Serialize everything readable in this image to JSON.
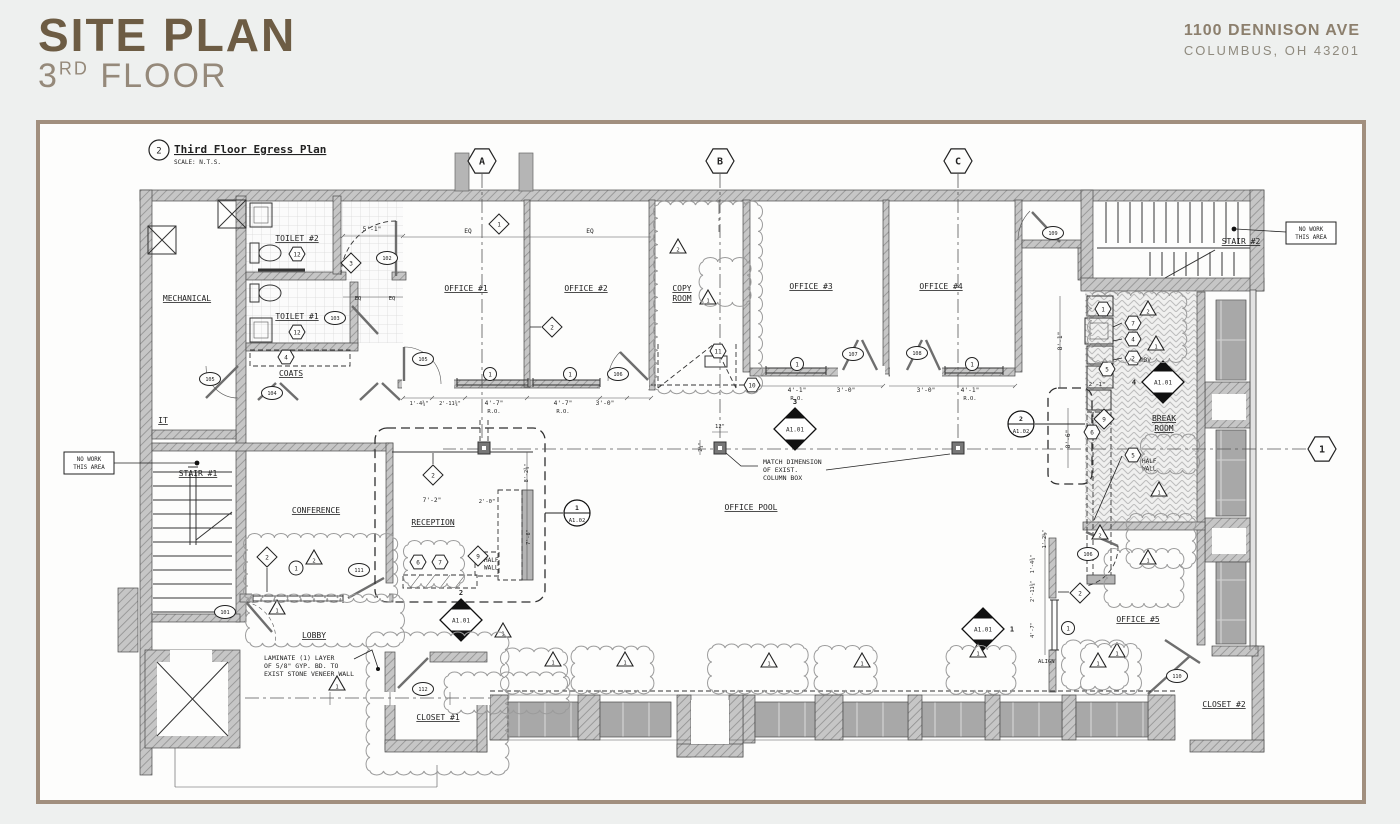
{
  "header": {
    "title": "SITE PLAN",
    "subtitle": {
      "num": "3",
      "sup": "RD",
      "rest": " FLOOR"
    },
    "address1": "1100 DENNISON AVE",
    "address2": "COLUMBUS, OH 43201",
    "title_color": "#6d5c44",
    "frame_color": "#a18f7e"
  },
  "plan": {
    "title_block": {
      "number": "2",
      "title": "Third Floor Egress Plan",
      "scale": "SCALE: N.T.S."
    },
    "rooms": [
      {
        "t": "MECHANICAL",
        "x": 187,
        "y": 301
      },
      {
        "t": "IT",
        "x": 163,
        "y": 423
      },
      {
        "t": "TOILET #2",
        "x": 297,
        "y": 241
      },
      {
        "t": "TOILET #1",
        "x": 297,
        "y": 319
      },
      {
        "t": "COATS",
        "x": 291,
        "y": 376
      },
      {
        "t": "STAIR #1",
        "x": 198,
        "y": 476
      },
      {
        "t": "STAIR #2",
        "x": 1241,
        "y": 244
      },
      {
        "t": "CONFERENCE",
        "x": 316,
        "y": 513
      },
      {
        "t": "RECEPTION",
        "x": 433,
        "y": 525
      },
      {
        "t": "LOBBY",
        "x": 314,
        "y": 638
      },
      {
        "t": "CLOSET #1",
        "x": 438,
        "y": 720
      },
      {
        "t": "CLOSET #2",
        "x": 1224,
        "y": 707
      },
      {
        "t": "OFFICE #1",
        "x": 466,
        "y": 291
      },
      {
        "t": "OFFICE #2",
        "x": 586,
        "y": 291
      },
      {
        "t": "OFFICE #3",
        "x": 811,
        "y": 289
      },
      {
        "t": "OFFICE #4",
        "x": 941,
        "y": 289
      },
      {
        "t": "OFFICE #5",
        "x": 1138,
        "y": 622
      },
      {
        "t": "OFFICE POOL",
        "x": 751,
        "y": 510
      },
      {
        "t": "COPY",
        "x": 682,
        "y": 291
      },
      {
        "t": "ROOM",
        "x": 682,
        "y": 301
      },
      {
        "t": "BREAK",
        "x": 1164,
        "y": 421
      },
      {
        "t": "ROOM",
        "x": 1164,
        "y": 431
      }
    ],
    "notes": [
      {
        "lines": [
          "MATCH DIMENSION",
          "OF EXIST.",
          "COLUMN BOX"
        ],
        "x": 763,
        "y": 464,
        "s": 6.5
      },
      {
        "lines": [
          "LAMINATE (1) LAYER",
          "OF 5/8\" GYP. BD. TO",
          "EXIST STONE VENEER WALL"
        ],
        "x": 264,
        "y": 660,
        "s": 6.5
      },
      {
        "lines": [
          "HALF",
          "WALL"
        ],
        "x": 484,
        "y": 562,
        "s": 6
      },
      {
        "lines": [
          "HALF",
          "WALL"
        ],
        "x": 1142,
        "y": 463,
        "s": 6
      },
      {
        "lines": [
          "ABV"
        ],
        "x": 1140,
        "y": 362,
        "s": 6
      },
      {
        "lines": [
          "ALIGN"
        ],
        "x": 1038,
        "y": 663,
        "s": 5.5
      }
    ],
    "no_work_boxes": [
      {
        "lines": [
          "NO WORK",
          "THIS AREA"
        ],
        "x": 64,
        "y": 452,
        "w": 50,
        "h": 22,
        "leader": [
          114,
          463,
          195,
          463
        ],
        "dot": [
          197,
          463
        ]
      },
      {
        "lines": [
          "NO WORK",
          "THIS AREA"
        ],
        "x": 1286,
        "y": 222,
        "w": 50,
        "h": 22,
        "leader": [
          1286,
          232,
          1236,
          229
        ],
        "dot": [
          1234,
          229
        ]
      }
    ],
    "dims": [
      {
        "t": "5'-1\"",
        "x": 372,
        "y": 231
      },
      {
        "t": "EQ",
        "x": 358,
        "y": 300,
        "s": 5.5
      },
      {
        "t": "EQ",
        "x": 392,
        "y": 300,
        "s": 5.5
      },
      {
        "t": "EQ",
        "x": 468,
        "y": 233
      },
      {
        "t": "EQ",
        "x": 590,
        "y": 233
      },
      {
        "t": "1'-4¾\"",
        "x": 419,
        "y": 405,
        "s": 5.2
      },
      {
        "t": "2'-11¾\"",
        "x": 450,
        "y": 405,
        "s": 5.2
      },
      {
        "t": "4'-7\"",
        "x": 494,
        "y": 405
      },
      {
        "t": "R.O.",
        "x": 494,
        "y": 413,
        "s": 5.5
      },
      {
        "t": "4'-7\"",
        "x": 563,
        "y": 405
      },
      {
        "t": "R.O.",
        "x": 563,
        "y": 413,
        "s": 5.5
      },
      {
        "t": "3'-0\"",
        "x": 605,
        "y": 405
      },
      {
        "t": "4'-1\"",
        "x": 797,
        "y": 392
      },
      {
        "t": "R.O.",
        "x": 797,
        "y": 400,
        "s": 5.5
      },
      {
        "t": "3'-0\"",
        "x": 846,
        "y": 392
      },
      {
        "t": "3'-0\"",
        "x": 926,
        "y": 392
      },
      {
        "t": "4'-1\"",
        "x": 970,
        "y": 392
      },
      {
        "t": "R.O.",
        "x": 970,
        "y": 400,
        "s": 5.5
      },
      {
        "t": "12\"",
        "x": 720,
        "y": 428,
        "s": 5.5
      },
      {
        "t": "2¼\"",
        "x": 702,
        "y": 447,
        "r": -90,
        "s": 5.2
      },
      {
        "t": "8'-1\"",
        "x": 1062,
        "y": 341,
        "r": -90
      },
      {
        "t": "2'-1\"",
        "x": 1097,
        "y": 386,
        "s": 5.5
      },
      {
        "t": "8'-6\"",
        "x": 1070,
        "y": 439,
        "r": -90
      },
      {
        "t": "8'-2¾\"",
        "x": 528,
        "y": 473,
        "r": -90,
        "s": 5.2
      },
      {
        "t": "7'-6\"",
        "x": 530,
        "y": 537,
        "r": -90,
        "s": 5.2
      },
      {
        "t": "7'-2\"",
        "x": 432,
        "y": 502
      },
      {
        "t": "2'-0\"",
        "x": 487,
        "y": 503,
        "s": 5.5
      },
      {
        "t": "1'-2½\"",
        "x": 1046,
        "y": 539,
        "r": -90,
        "s": 5.2
      },
      {
        "t": "1'-4¾\"",
        "x": 1034,
        "y": 564,
        "r": -90,
        "s": 5.2
      },
      {
        "t": "2'-11¾\"",
        "x": 1034,
        "y": 591,
        "r": -90,
        "s": 5.2
      },
      {
        "t": "4'-7\"",
        "x": 1034,
        "y": 630,
        "r": -90,
        "s": 5.2
      }
    ],
    "grid_markers": [
      {
        "l": "A",
        "x": 482,
        "y": 161,
        "line": [
          482,
          174,
          482,
          446
        ]
      },
      {
        "l": "B",
        "x": 720,
        "y": 161,
        "line": [
          720,
          174,
          720,
          446
        ]
      },
      {
        "l": "C",
        "x": 958,
        "y": 161,
        "line": [
          958,
          174,
          958,
          446
        ]
      },
      {
        "l": "1",
        "x": 1322,
        "y": 449,
        "line": [
          1306,
          449,
          443,
          449
        ]
      }
    ],
    "section_markers": [
      {
        "x": 795,
        "y": 429,
        "sheet": "A1.01",
        "n": "3",
        "side": "top"
      },
      {
        "x": 461,
        "y": 620,
        "sheet": "A1.01",
        "n": "2",
        "side": "top"
      },
      {
        "x": 1163,
        "y": 382,
        "sheet": "A1.01",
        "n": "4",
        "side": "left"
      },
      {
        "x": 983,
        "y": 629,
        "sheet": "A1.01",
        "n": "1",
        "side": "right"
      }
    ],
    "detail_markers": [
      {
        "x": 577,
        "y": 513,
        "n": "1",
        "sheet": "A1.02",
        "leader": [
          563,
          513,
          545,
          513
        ]
      },
      {
        "x": 1021,
        "y": 424,
        "n": "2",
        "sheet": "A1.02",
        "leader": [
          1035,
          424,
          1085,
          424
        ]
      }
    ],
    "hex_keynotes": [
      {
        "n": "12",
        "x": 297,
        "y": 254
      },
      {
        "n": "12",
        "x": 297,
        "y": 332
      },
      {
        "n": "4",
        "x": 286,
        "y": 357
      },
      {
        "n": "11",
        "x": 718,
        "y": 351
      },
      {
        "n": "10",
        "x": 752,
        "y": 385
      },
      {
        "n": "1",
        "x": 1103,
        "y": 309
      },
      {
        "n": "7",
        "x": 1133,
        "y": 323
      },
      {
        "n": "4",
        "x": 1133,
        "y": 339
      },
      {
        "n": "2",
        "x": 1133,
        "y": 358
      },
      {
        "n": "5",
        "x": 1107,
        "y": 369
      },
      {
        "n": "6",
        "x": 1092,
        "y": 432
      },
      {
        "n": "5",
        "x": 1133,
        "y": 455
      },
      {
        "n": "6",
        "x": 418,
        "y": 562
      },
      {
        "n": "7",
        "x": 440,
        "y": 562
      }
    ],
    "diamond_keynotes": [
      {
        "n": "1",
        "x": 499,
        "y": 224
      },
      {
        "n": "2",
        "x": 552,
        "y": 327
      },
      {
        "n": "3",
        "x": 351,
        "y": 263
      },
      {
        "n": "2",
        "x": 433,
        "y": 475
      },
      {
        "n": "2",
        "x": 267,
        "y": 557
      },
      {
        "n": "9",
        "x": 478,
        "y": 556
      },
      {
        "n": "2",
        "x": 1080,
        "y": 593
      },
      {
        "n": "9",
        "x": 1104,
        "y": 419
      }
    ],
    "circle_keynotes": [
      {
        "n": "1",
        "x": 296,
        "y": 568
      }
    ],
    "window_tags": [
      {
        "n": "1",
        "x": 490,
        "y": 374
      },
      {
        "n": "1",
        "x": 570,
        "y": 374
      },
      {
        "n": "1",
        "x": 797,
        "y": 364
      },
      {
        "n": "1",
        "x": 972,
        "y": 364
      },
      {
        "n": "1",
        "x": 1068,
        "y": 628
      }
    ],
    "door_tags": [
      {
        "n": "101",
        "x": 225,
        "y": 612
      },
      {
        "n": "102",
        "x": 387,
        "y": 258
      },
      {
        "n": "103",
        "x": 335,
        "y": 318
      },
      {
        "n": "104",
        "x": 272,
        "y": 393
      },
      {
        "n": "105",
        "x": 210,
        "y": 379
      },
      {
        "n": "105",
        "x": 423,
        "y": 359
      },
      {
        "n": "106",
        "x": 618,
        "y": 374
      },
      {
        "n": "107",
        "x": 853,
        "y": 354
      },
      {
        "n": "108",
        "x": 917,
        "y": 353
      },
      {
        "n": "109",
        "x": 1053,
        "y": 233
      },
      {
        "n": "110",
        "x": 1177,
        "y": 676
      },
      {
        "n": "111",
        "x": 359,
        "y": 570
      },
      {
        "n": "112",
        "x": 423,
        "y": 689
      },
      {
        "n": "106",
        "x": 1088,
        "y": 554
      }
    ],
    "triangles": [
      {
        "n": "2",
        "x": 678,
        "y": 247
      },
      {
        "n": "1",
        "x": 708,
        "y": 298
      },
      {
        "n": "2",
        "x": 314,
        "y": 558
      },
      {
        "n": "1",
        "x": 277,
        "y": 608
      },
      {
        "n": "2",
        "x": 1100,
        "y": 533
      },
      {
        "n": "1",
        "x": 1148,
        "y": 558
      },
      {
        "n": "1",
        "x": 1098,
        "y": 661
      },
      {
        "n": "2",
        "x": 1148,
        "y": 309
      },
      {
        "n": "1",
        "x": 1156,
        "y": 344
      },
      {
        "n": "1",
        "x": 1159,
        "y": 490
      },
      {
        "n": "1",
        "x": 503,
        "y": 631
      },
      {
        "n": "1",
        "x": 553,
        "y": 660
      },
      {
        "n": "1",
        "x": 625,
        "y": 660
      },
      {
        "n": "1",
        "x": 769,
        "y": 661
      },
      {
        "n": "1",
        "x": 862,
        "y": 661
      },
      {
        "n": "1",
        "x": 978,
        "y": 651
      },
      {
        "n": "1",
        "x": 1117,
        "y": 651
      },
      {
        "n": "1",
        "x": 337,
        "y": 684
      }
    ],
    "columns": [
      {
        "x": 484,
        "y": 448
      },
      {
        "x": 720,
        "y": 448
      },
      {
        "x": 958,
        "y": 448
      }
    ],
    "clouds": [
      [
        658,
        205,
        100,
        185
      ],
      [
        703,
        262,
        44,
        40
      ],
      [
        248,
        538,
        145,
        60
      ],
      [
        250,
        598,
        150,
        45
      ],
      [
        370,
        636,
        135,
        135
      ],
      [
        408,
        545,
        52,
        38
      ],
      [
        505,
        652,
        58,
        38
      ],
      [
        575,
        650,
        75,
        40
      ],
      [
        712,
        648,
        92,
        42
      ],
      [
        818,
        650,
        55,
        40
      ],
      [
        950,
        650,
        62,
        40
      ],
      [
        1066,
        644,
        58,
        42
      ],
      [
        1108,
        553,
        72,
        50
      ],
      [
        1085,
        648,
        52,
        42
      ],
      [
        1145,
        438,
        50,
        32
      ],
      [
        1092,
        296,
        90,
        62
      ],
      [
        448,
        676,
        118,
        34
      ],
      [
        1130,
        518,
        62,
        46
      ]
    ],
    "leaders": [
      {
        "pts": [
          758,
          466,
          741,
          466,
          726,
          453
        ]
      },
      {
        "pts": [
          826,
          470,
          950,
          454
        ]
      },
      {
        "pts": [
          354,
          659,
          372,
          650,
          378,
          668
        ],
        "dot": [
          378,
          669
        ]
      },
      {
        "pts": [
          541,
          327,
          530,
          327
        ]
      },
      {
        "pts": [
          433,
          464,
          433,
          453
        ]
      },
      {
        "pts": [
          267,
          568,
          267,
          592
        ]
      },
      {
        "pts": [
          1069,
          592,
          1058,
          592
        ]
      },
      {
        "pts": [
          1122,
          323,
          1113,
          327
        ]
      },
      {
        "pts": [
          1122,
          339,
          1113,
          341
        ]
      },
      {
        "pts": [
          1122,
          358,
          1113,
          360
        ]
      },
      {
        "pts": [
          1122,
          456,
          1094,
          520
        ]
      }
    ]
  }
}
